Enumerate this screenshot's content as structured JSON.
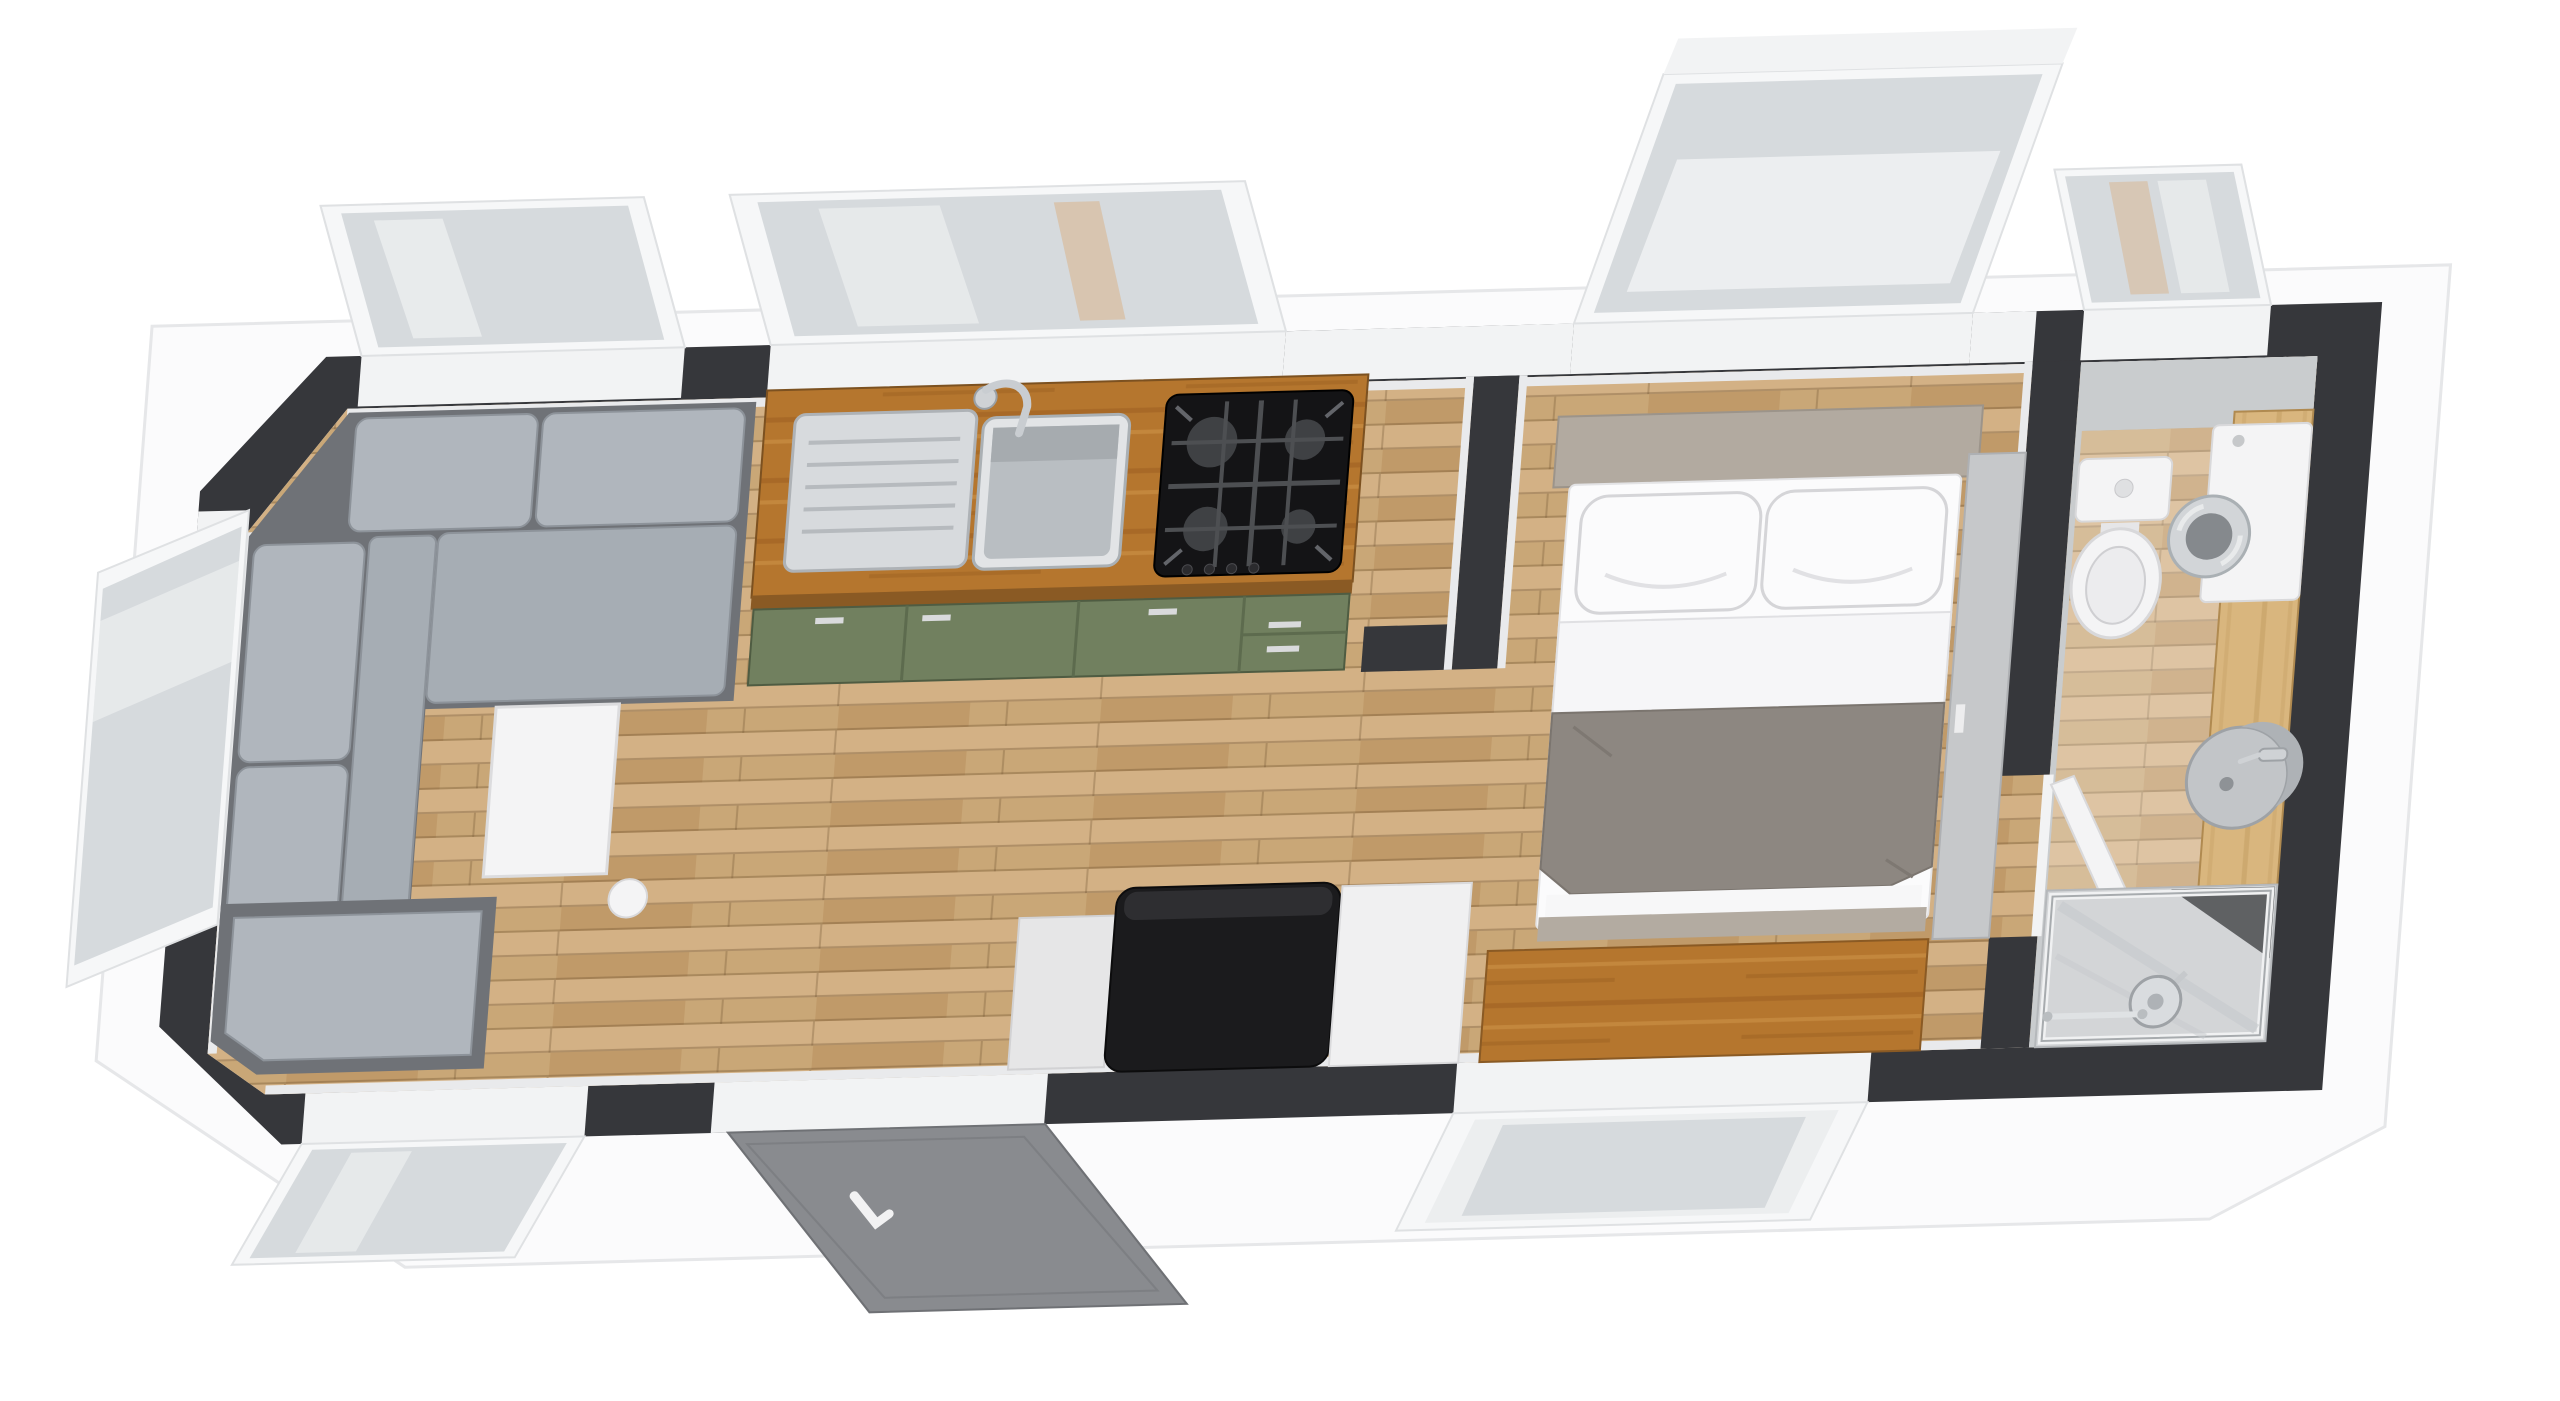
{
  "meta": {
    "scene": "isometric-3d-floor-plan-render",
    "dwelling": "tiny-house-studio",
    "view": "top-down-oblique"
  },
  "palette": {
    "bg": "#ffffff",
    "wall_dark": "#36373b",
    "wall_face": "#e9eaec",
    "slab": "#fbfbfc",
    "sill_white": "#f2f3f4",
    "floor_base": "#c9a777",
    "floor_light": "#d3b185",
    "floor_dark": "#c09a69",
    "counter_wood": "#b5762e",
    "counter_grain_dark": "#9c5f21",
    "counter_grain_light": "#cd9248",
    "light_wood": "#d9b67e",
    "light_wood_grain": "#c29c60",
    "cabinet_green": "#71805f",
    "cabinet_green_line": "#5d6b4e",
    "steel_light": "#d7dadd",
    "steel_mid": "#b9bec2",
    "hob_black": "#141416",
    "burner_gray": "#3f4144",
    "sofa_base": "#6f7277",
    "sofa_cushion": "#b0b6bd",
    "sofa_seat": "#a6adb4",
    "table_white": "#f4f4f5",
    "appliance_black": "#1b1b1d",
    "appliance_top": "#2e2e31",
    "door_gray": "#898b8f",
    "bed_white": "#fbfbfc",
    "duvet_white": "#f6f6f8",
    "blanket_gray": "#8d8781",
    "bed_base_taupe": "#b3aba1",
    "headboard_taupe": "#b2aaa0",
    "wardrobe_gray": "#c6c8ca",
    "bath_wall": "#c9ccce",
    "fixture_white": "#f4f4f5",
    "sink_gray": "#c2c5c8",
    "shower_tray": "#d3d5d7",
    "shower_dark": "#4a4c4f",
    "chrome": "#cfd2d5",
    "glass": "#d6dadd",
    "frame_white": "#f6f7f8"
  },
  "rooms": [
    {
      "id": "living-room",
      "furniture": [
        "l-shaped-sectional-sofa",
        "chaise-ottoman",
        "white-side-table",
        "decor-bowl",
        "corner-window",
        "side-window",
        "low-window"
      ]
    },
    {
      "id": "kitchen",
      "furniture": [
        "wood-countertop",
        "stainless-sink-with-drainboard",
        "chrome-faucet",
        "gas-hob-4-burner",
        "green-base-cabinets",
        "kitchen-window"
      ]
    },
    {
      "id": "entry",
      "furniture": [
        "entry-door-ajar",
        "black-appliance-unit",
        "white-side-cabinet",
        "white-panel"
      ]
    },
    {
      "id": "bedroom",
      "furniture": [
        "double-bed",
        "pillows",
        "gray-blanket",
        "taupe-headboard",
        "large-tilted-window",
        "wood-console-desk",
        "low-window",
        "wardrobe-panel"
      ]
    },
    {
      "id": "bathroom",
      "furniture": [
        "toilet",
        "washing-machine",
        "wood-vanity-counter",
        "round-vessel-sink",
        "walk-in-shower",
        "shower-head",
        "towel-bar",
        "bathroom-window",
        "bathroom-door"
      ]
    }
  ]
}
